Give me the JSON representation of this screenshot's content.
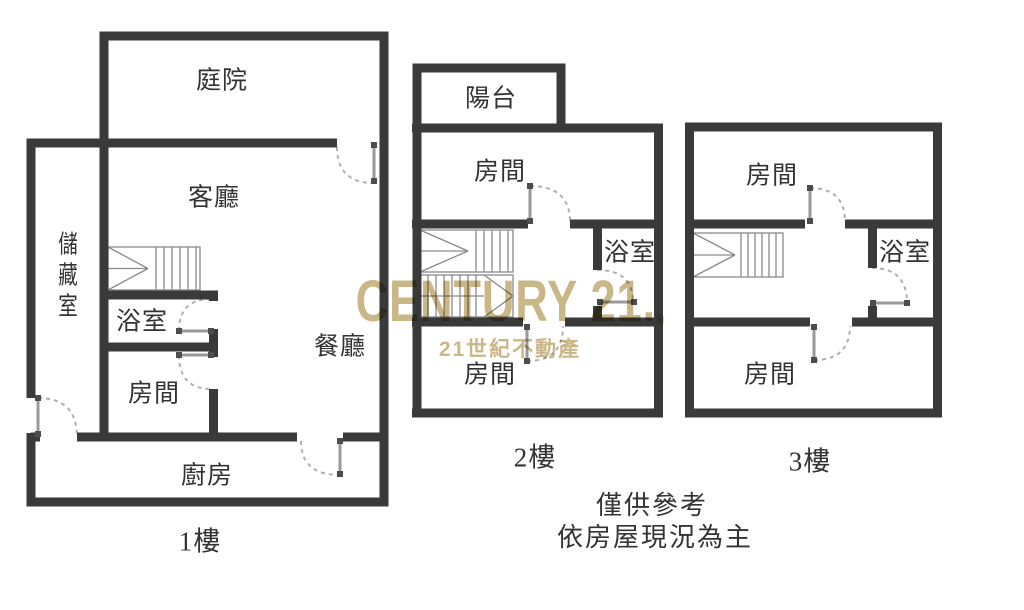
{
  "colors": {
    "wall": "#3a3a3a",
    "brand_gold": "#c6b17d",
    "label_text": "#333333"
  },
  "watermark": {
    "brand": "CENTURY 21.",
    "registered": "®",
    "subtitle": "21世紀不動產"
  },
  "disclaimer": {
    "line1": "僅供參考",
    "line2": "依房屋現況為主"
  },
  "floors": [
    {
      "id": "floor-1",
      "label": "1樓",
      "rooms": {
        "courtyard": "庭院",
        "living_room": "客廳",
        "storage": "儲藏室",
        "bathroom": "浴室",
        "bedroom": "房間",
        "dining_room": "餐廳",
        "kitchen": "廚房"
      }
    },
    {
      "id": "floor-2",
      "label": "2樓",
      "rooms": {
        "balcony": "陽台",
        "bedroom_upper": "房間",
        "bathroom": "浴室",
        "bedroom_lower": "房間"
      }
    },
    {
      "id": "floor-3",
      "label": "3樓",
      "rooms": {
        "bedroom_upper": "房間",
        "bathroom": "浴室",
        "bedroom_lower": "房間"
      }
    }
  ]
}
